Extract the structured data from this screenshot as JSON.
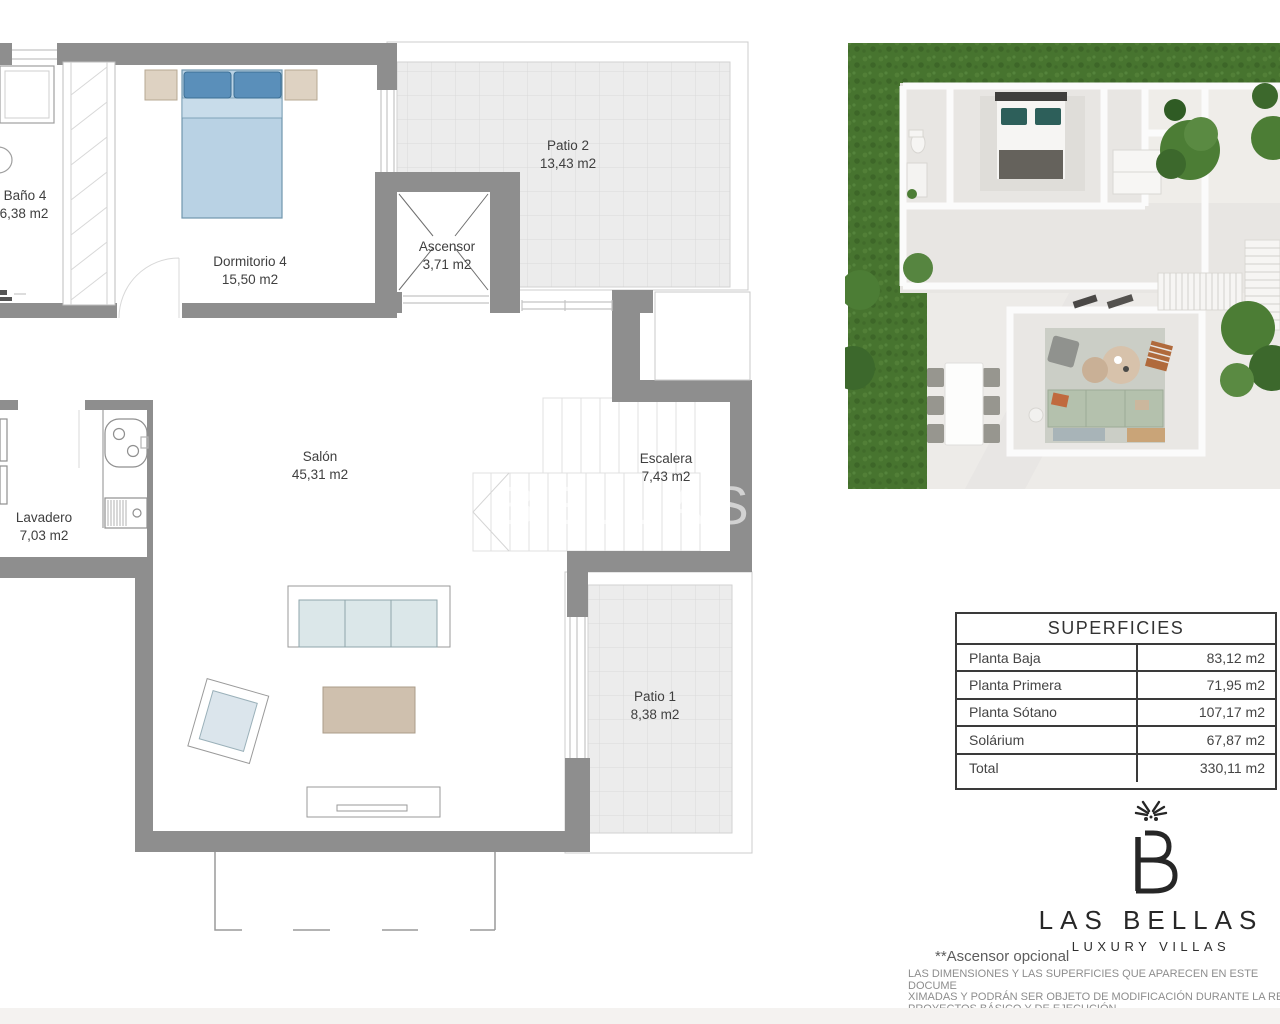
{
  "floorplan": {
    "rooms": [
      {
        "id": "bano4",
        "name": "Baño 4",
        "area": "6,38 m2"
      },
      {
        "id": "dormitorio4",
        "name": "Dormitorio 4",
        "area": "15,50 m2"
      },
      {
        "id": "ascensor",
        "name": "Ascensor",
        "area": "3,71 m2"
      },
      {
        "id": "patio2",
        "name": "Patio 2",
        "area": "13,43 m2"
      },
      {
        "id": "salon",
        "name": "Salón",
        "area": "45,31 m2"
      },
      {
        "id": "escalera",
        "name": "Escalera",
        "area": "7,43 m2"
      },
      {
        "id": "lavadero",
        "name": "Lavadero",
        "area": "7,03 m2"
      },
      {
        "id": "patio1",
        "name": "Patio 1",
        "area": "8,38 m2"
      }
    ],
    "watermark_text": "LAS BELLAS"
  },
  "surfaces_table": {
    "title": "SUPERFICIES",
    "rows": [
      {
        "label": "Planta Baja",
        "value": "83,12 m2"
      },
      {
        "label": "Planta Primera",
        "value": "71,95 m2"
      },
      {
        "label": "Planta Sótano",
        "value": "107,17 m2"
      },
      {
        "label": "Solárium",
        "value": "67,87 m2"
      },
      {
        "label": "Total",
        "value": "330,11 m2"
      }
    ]
  },
  "brand": {
    "monogram": "B",
    "name": "LAS BELLAS",
    "tagline": "LUXURY VILLAS"
  },
  "footnotes": {
    "elevator_note": "**Ascensor opcional",
    "disclaimer_lines": [
      "LAS DIMENSIONES Y LAS SUPERFICIES QUE APARECEN EN ESTE DOCUME",
      "XIMADAS Y PODRÁN SER OBJETO DE MODIFICACIÓN DURANTE LA RED",
      "PROYECTOS BÁSICO Y DE EJECUCIÓN"
    ]
  },
  "colors": {
    "wall_gray": "#8e8e8e",
    "patio_tile": "#ececec",
    "bed_blue": "#b9d2e4",
    "pillow_blue": "#5a8fba",
    "nightstand_beige": "#ded2c2",
    "sofa_cushion": "#dbe7e9",
    "coffee_table_tan": "#cfc0ae",
    "grass_green": "#47742f",
    "sage_sofa": "#b4c1ad",
    "teal_pillow": "#2d5f5a",
    "label_text": "#3f3f3f",
    "disclaimer_text": "#8d8d8d"
  }
}
